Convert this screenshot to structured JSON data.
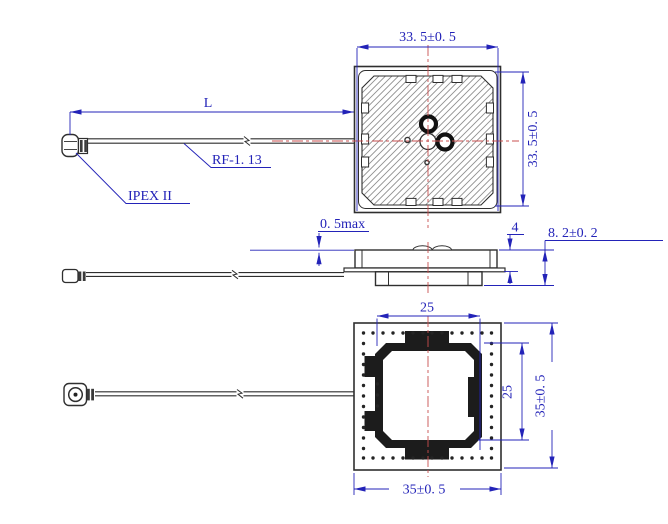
{
  "drawing_title": "patch-antenna-with-ipex-cable",
  "colors": {
    "dimension": "#2323b8",
    "centerline": "#c94f4f",
    "outline": "#2f2f2f",
    "hatch": "#8f8f8f"
  },
  "labels": {
    "cable_length": "L",
    "cable_type": "RF-1. 13",
    "connector_type": "IPEX II"
  },
  "top_view": {
    "width": "33. 5±0. 5",
    "height": "33. 5±0. 5"
  },
  "side_view": {
    "protrusion": "0. 5max",
    "stack_height": "4",
    "total_height": "8. 2±0. 2"
  },
  "bottom_view": {
    "shield_width": "25",
    "shield_height": "25",
    "board_width": "35±0. 5",
    "board_height": "35±0. 5"
  }
}
